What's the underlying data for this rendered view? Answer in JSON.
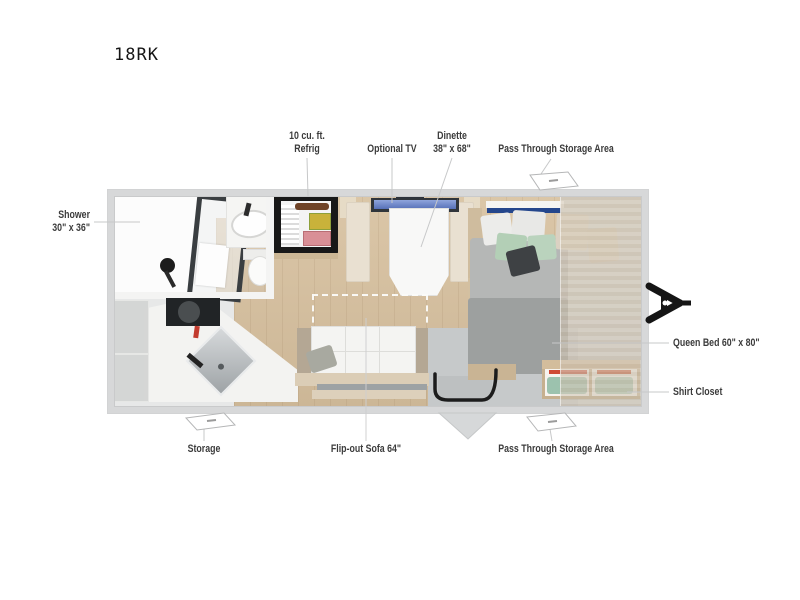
{
  "page": {
    "title": "18RK",
    "background": "#ffffff"
  },
  "annotations": {
    "refrig": {
      "line1": "10 cu. ft.",
      "line2": "Refrig"
    },
    "optional_tv": {
      "text": "Optional TV"
    },
    "dinette": {
      "line1": "Dinette",
      "line2": "38\" x 68\""
    },
    "pass_through_top": {
      "text": "Pass Through Storage Area"
    },
    "shower": {
      "line1": "Shower",
      "line2": "30\" x 36\""
    },
    "queen_bed": {
      "text": "Queen Bed 60\" x 80\""
    },
    "shirt_closet": {
      "text": "Shirt Closet"
    },
    "storage": {
      "text": "Storage"
    },
    "flip_out_sofa": {
      "text": "Flip-out Sofa 64\""
    },
    "pass_through_bottom": {
      "text": "Pass Through Storage Area"
    }
  },
  "icons": [
    "pass-through-door-icon-top",
    "pass-through-door-icon-bottom",
    "storage-door-icon",
    "entry-step-icon",
    "trailer-hitch-icon"
  ],
  "colors": {
    "label_text": "#3b3b3b",
    "leader_line": "#c7c8c9",
    "wall": "#d7d8d9",
    "wood_floor": "#d7c09e",
    "entry_floor": "#c6c9ca",
    "tv_screen": "#7b93d0",
    "headboard_accent_blue": "#24468c",
    "bed_duvet": "#9da09f",
    "pillow_mint": "#b3cfb6",
    "hitch_black": "#151515"
  }
}
